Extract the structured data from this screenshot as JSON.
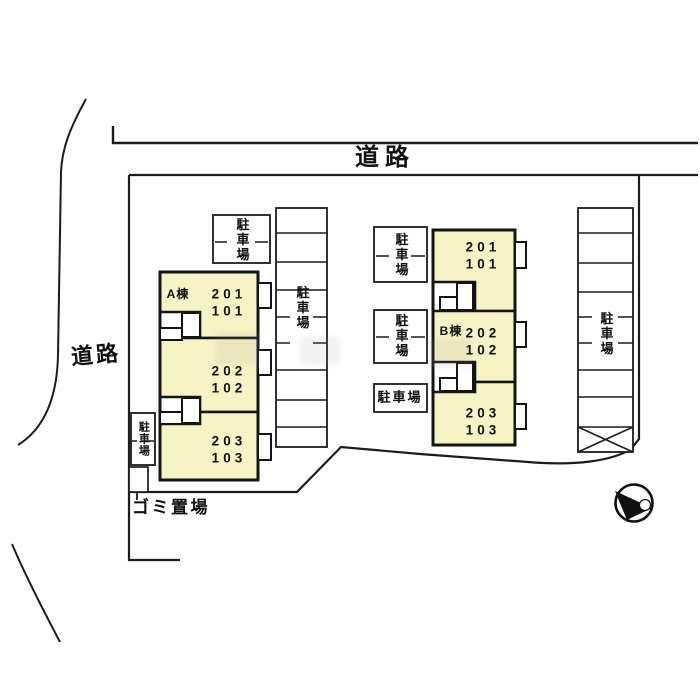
{
  "plan": {
    "road_top_label": "道路",
    "road_left_label": "道路",
    "garbage_label": "ゴミ置場",
    "buildings": [
      {
        "name": "A棟",
        "units": [
          {
            "upper": "201",
            "lower": "101"
          },
          {
            "upper": "202",
            "lower": "102"
          },
          {
            "upper": "203",
            "lower": "103"
          }
        ]
      },
      {
        "name": "B棟",
        "units": [
          {
            "upper": "201",
            "lower": "101"
          },
          {
            "upper": "202",
            "lower": "102"
          },
          {
            "upper": "203",
            "lower": "103"
          }
        ]
      }
    ],
    "parking_lots": [
      {
        "id": "a-top",
        "label": "駐車場"
      },
      {
        "id": "center-column",
        "label": "駐車場"
      },
      {
        "id": "a-left",
        "label": "駐車場"
      },
      {
        "id": "b-row-1",
        "label": "駐車場"
      },
      {
        "id": "b-row-2",
        "label": "駐車場"
      },
      {
        "id": "b-row-3",
        "label": "駐車場"
      },
      {
        "id": "right-column",
        "label": "駐車場"
      }
    ],
    "colors": {
      "background": "#ffffff",
      "line": "#1c1c1c",
      "building_fill": "#f6f3c5"
    }
  }
}
